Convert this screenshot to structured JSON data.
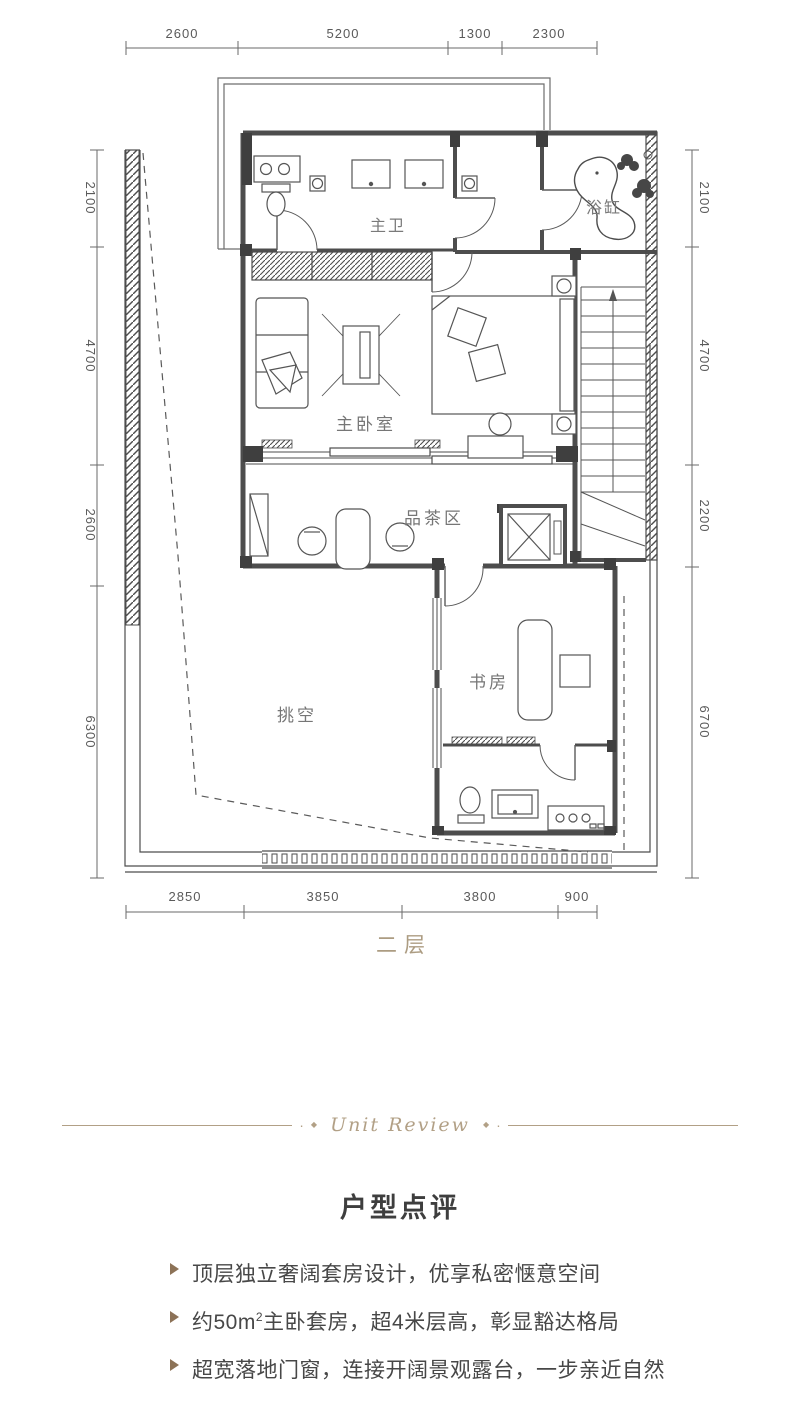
{
  "plan": {
    "floor_label": "二层",
    "dims": {
      "top": [
        "2600",
        "5200",
        "1300",
        "2300"
      ],
      "left": [
        "2100",
        "4700",
        "2600",
        "6300"
      ],
      "right": [
        "2100",
        "4700",
        "2200",
        "6700"
      ],
      "bottom": [
        "2850",
        "3850",
        "3800",
        "900"
      ]
    },
    "rooms": {
      "master_bath": "主卫",
      "bathtub": "浴缸",
      "master_bedroom": "主卧室",
      "tea_area": "品茶区",
      "study": "书房",
      "void": "挑空"
    }
  },
  "divider": {
    "label": "Unit Review"
  },
  "review": {
    "title": "户型点评",
    "bullets": [
      {
        "pre": "顶层独立奢阔套房设计，优享私密惬意空间",
        "sup": "",
        "post": ""
      },
      {
        "pre": "约50m",
        "sup": "2",
        "post": "主卧套房，超4米层高，彰显豁达格局"
      },
      {
        "pre": "超宽落地门窗，连接开阔景观露台，一步亲近自然",
        "sup": "",
        "post": ""
      }
    ]
  },
  "colors": {
    "accent": "#b2a086",
    "line": "#4d4d4d",
    "text": "#474747",
    "bullet_marker": "#8c7257"
  }
}
